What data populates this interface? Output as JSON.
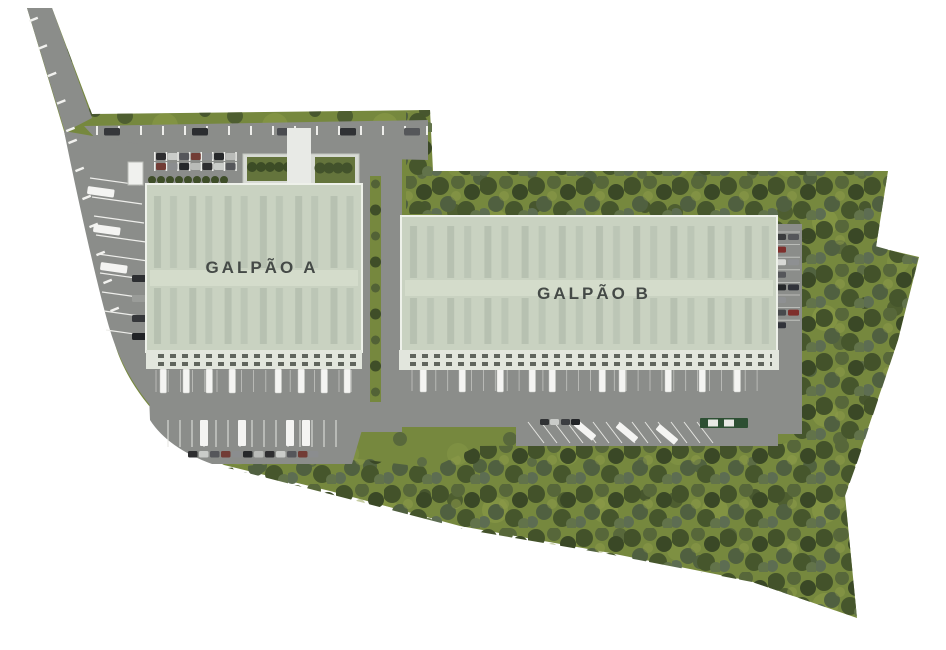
{
  "site_plan": {
    "warehouse_a_label": "GALPÃO A",
    "warehouse_b_label": "GALPÃO B"
  },
  "palette": {
    "background": "#ffffff",
    "grass": "#76883e",
    "grass_light": "#9aa94e",
    "forest_dark": "#43522a",
    "road": "#8b8d8a",
    "roof": "#c9d2c1",
    "roof_stripe": "#b7c1b1",
    "roof_midband": "#d4dccb",
    "canopy": "#e2e6dd",
    "dock_door": "#60655d",
    "office": "#d7dad4",
    "walkway": "#e8eae6",
    "green_roof": "#64743c",
    "truck_white": "#f4f4f2",
    "truck_green": "#2d4f33",
    "label_text": "#454a47"
  }
}
